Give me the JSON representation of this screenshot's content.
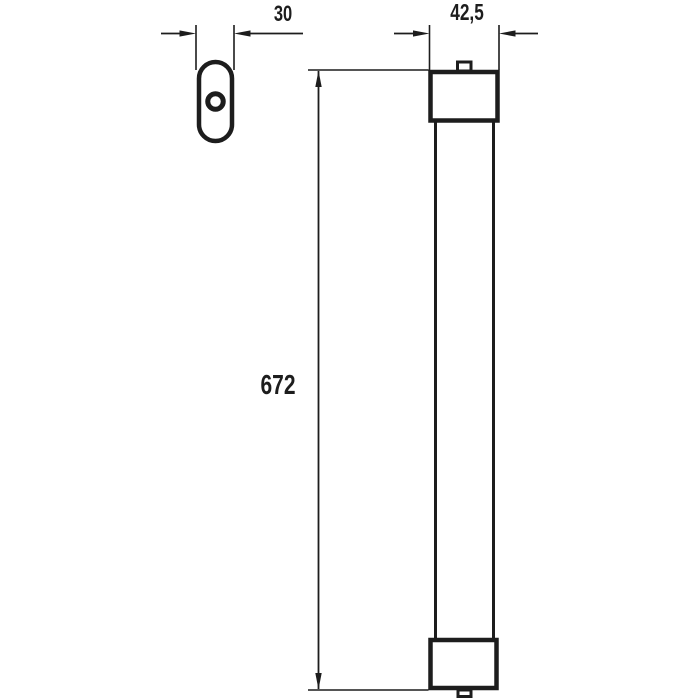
{
  "drawing": {
    "dimensions": {
      "end_view_width": "30",
      "side_view_width": "42,5",
      "side_view_length": "672"
    },
    "colors": {
      "line": "#1d1d1d",
      "background": "#ffffff"
    }
  }
}
